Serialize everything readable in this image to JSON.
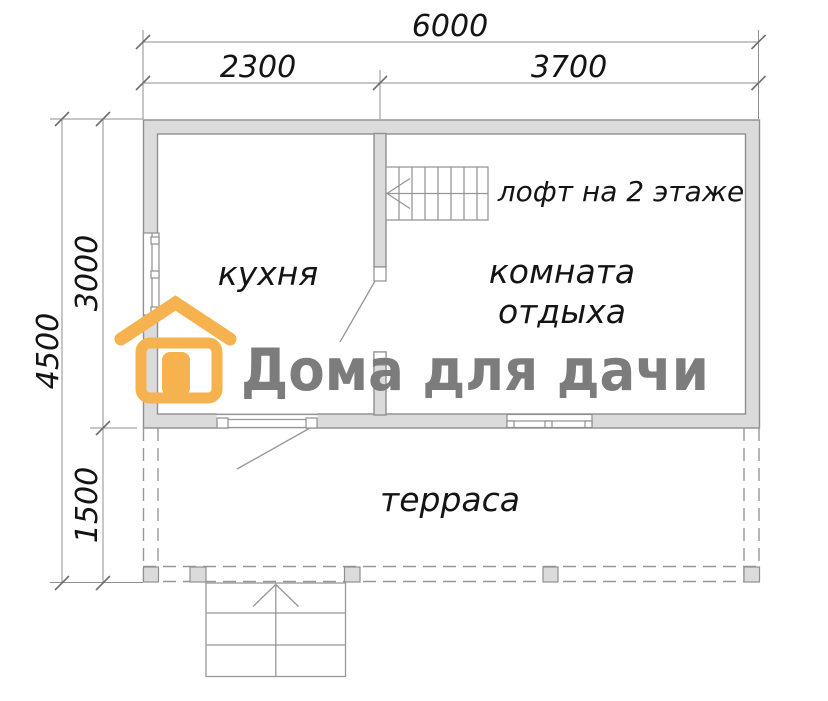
{
  "plan": {
    "dimensions": {
      "width_total": "6000",
      "width_kitchen": "2300",
      "width_lounge": "3700",
      "height_total": "4500",
      "height_house": "3000",
      "height_terrace": "1500"
    },
    "labels": {
      "kitchen": "кухня",
      "lounge_line1": "комната",
      "lounge_line2": "отдыха",
      "loft_note": "лофт на 2 этаже",
      "terrace": "терраса"
    }
  },
  "logo": {
    "text": "Дома для дачи",
    "icon": "house-icon",
    "accent_color": "#F6B24E",
    "text_color": "#7C7C7C"
  },
  "colors": {
    "wall_fill": "#DBDBDB",
    "wall_stroke": "#8F8F8F",
    "detail_line": "#979797",
    "dimension_line": "#8F8F8F",
    "text": "#141414",
    "background": "#FFFFFF"
  }
}
